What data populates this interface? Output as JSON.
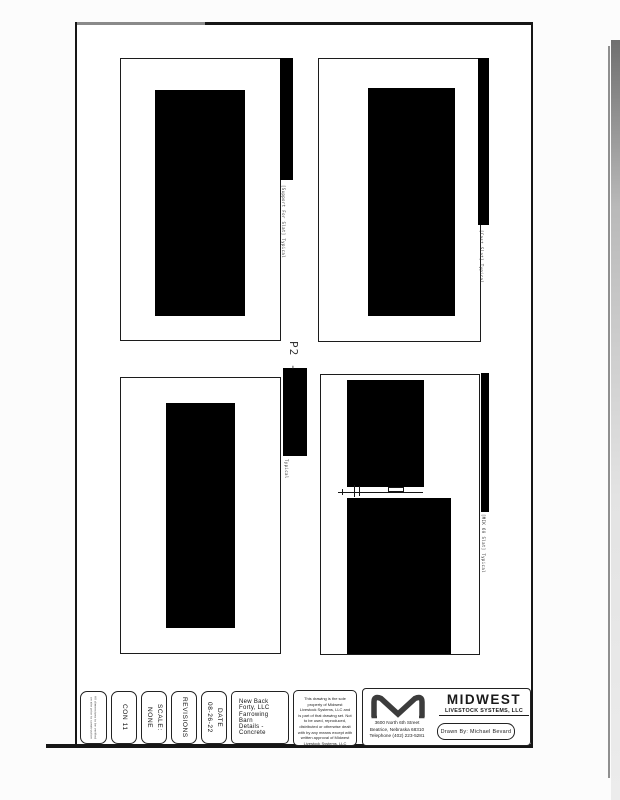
{
  "drawing": {
    "detail_number": "P2 -",
    "captions": {
      "top_left": "[Support For Slat]  Typical",
      "top_right": "[Cast Slat]  Typical",
      "center": "Typical",
      "bottom_right": "[MIK 60 Slat]  Typical"
    }
  },
  "title_block": {
    "fine_print": "All dimensions to be verified\non site prior to construction",
    "sheet_number": "CON 11",
    "scale": "SCALE:\nNONE",
    "revisions": "REVISIONS",
    "date": "DATE\n08-26-22",
    "project": {
      "client": "New Back Forty, LLC",
      "building": "Farrowing Barn",
      "sheet_title": "Details - Concrete"
    },
    "disclaimer": "This drawing is the sole\nproperty of Midwest\nLivestock Systems, LLC and\nis part of that drawing set. Not\nto be used, reproduced,\ndistributed or otherwise dealt\nwith by any means except with\nwritten approval of Midwest\nLivestock Systems, LLC",
    "company": {
      "name": "MIDWEST",
      "subname": "LIVESTOCK SYSTEMS, LLC",
      "address": "3600 North 6th Street\nBeatrice, Nebraska  68310\nTelephone  (402) 223-5281",
      "drawn_by": "Drawn By:   Michael Bevard"
    }
  },
  "colors": {
    "ink": "#161616",
    "redaction": "#000000",
    "scan_shadow": "#8f8f8f"
  }
}
